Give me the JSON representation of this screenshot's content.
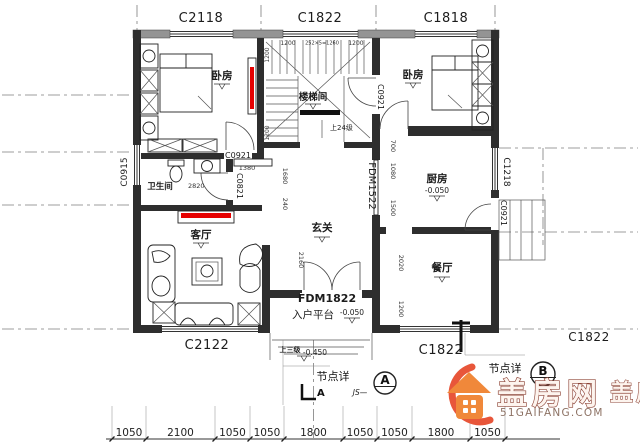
{
  "window_labels": {
    "c2118": "C2118",
    "c1822_top": "C1822",
    "c1818": "C1818",
    "c0915": "C0915",
    "c1218": "C1218",
    "c2122": "C2122",
    "c1822_bottom": "C1822",
    "c1822_right": "C1822"
  },
  "door_labels": {
    "bedroom1_door": "C0921",
    "bath_door": "C0821",
    "stair_door": "C0921",
    "kitchen_door": "C0921",
    "entry_inner_door": "FDM1522",
    "main_door": "FDM1822"
  },
  "rooms": {
    "bedroom_left": "卧房",
    "bedroom_right": "卧房",
    "staircase": "楼梯间",
    "bathroom": "卫生间",
    "kitchen": "厨房",
    "entry_hall": "玄关",
    "living_room": "客厅",
    "dining_room": "餐厅",
    "entry_platform": "入户平台"
  },
  "elevations": {
    "kitchen": "-0.050",
    "platform": "-0.050",
    "outdoor": "-0.450"
  },
  "notes": {
    "stair_up": "上24级",
    "steps_up": "上三级",
    "detail_label": "节点详",
    "detail_a": "A",
    "detail_b": "B",
    "detail_sheet": "JS—",
    "section_mark": "A"
  },
  "dimensions": {
    "bottom_row": [
      "1050",
      "2100",
      "1050",
      "1050",
      "1800",
      "1050",
      "1050",
      "1800",
      "1050"
    ],
    "bathroom_width": "2820",
    "shelf_width": "1380",
    "hall_chain": [
      "1680",
      "240",
      "2160"
    ],
    "stair_top": [
      "1200",
      "252×5=1260",
      "1200"
    ],
    "stair_side": [
      "1200",
      "1200"
    ],
    "kitchen_side": [
      "700",
      "1080",
      "1500"
    ],
    "dining_side": [
      "2020",
      "1200"
    ]
  },
  "logo": {
    "brand": "盖房网",
    "site": "51GAIFANG.COM",
    "brand_corner": "盖房网"
  },
  "colors": {
    "wall_dark": "#2e2e2e",
    "wall_gray": "#949494",
    "accent_red": "#e60000",
    "logo_orange": "#f0883a",
    "logo_red": "#e8563a",
    "logo_text_outline": "#8d4437"
  }
}
